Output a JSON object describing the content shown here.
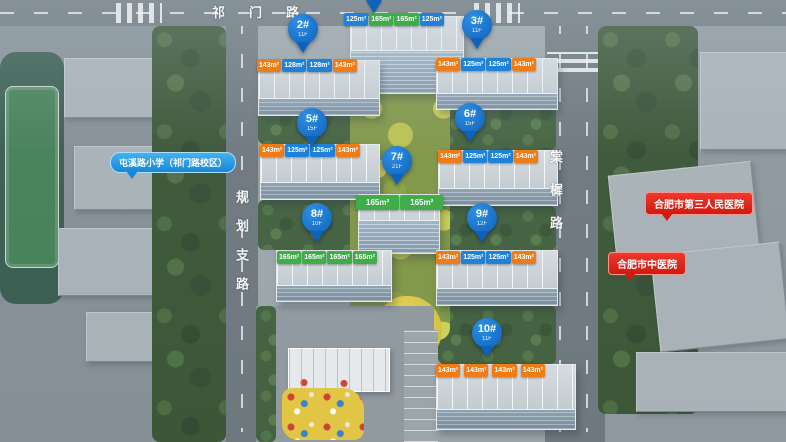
{
  "roads": {
    "top": "祁门路",
    "left": "规划支路",
    "right": "棠樨路"
  },
  "pois": {
    "school": "屯溪路小学（祁门路校区）",
    "hospital_1": "合肥市第三人民医院",
    "hospital_2": "合肥市中医院"
  },
  "colors": {
    "tag_blue": "#1e82da",
    "tag_green": "#3fae49",
    "tag_orange": "#ef7c16",
    "pin_blue": "#0d63bb",
    "bubble_blue": "#1887d6",
    "bubble_red": "#e1251b"
  },
  "buildings": [
    {
      "id": "",
      "sub": "",
      "tags": [
        "125m²",
        "165m²",
        "165m²",
        "125m²"
      ],
      "tag_colors": [
        "blue",
        "green",
        "green",
        "blue"
      ]
    },
    {
      "id": "2#",
      "sub": "11F",
      "tags": [
        "143m²",
        "128m²",
        "128m²",
        "143m²"
      ],
      "tag_colors": [
        "orange",
        "blue",
        "blue",
        "orange"
      ]
    },
    {
      "id": "3#",
      "sub": "11F",
      "tags": [
        "143m²",
        "125m²",
        "125m²",
        "143m²"
      ],
      "tag_colors": [
        "orange",
        "blue",
        "blue",
        "orange"
      ]
    },
    {
      "id": "5#",
      "sub": "15F",
      "tags": [
        "143m²",
        "125m²",
        "125m²",
        "143m²"
      ],
      "tag_colors": [
        "orange",
        "blue",
        "blue",
        "orange"
      ]
    },
    {
      "id": "6#",
      "sub": "15F",
      "tags": [
        "143m²",
        "125m²",
        "125m²",
        "143m²"
      ],
      "tag_colors": [
        "orange",
        "blue",
        "blue",
        "orange"
      ]
    },
    {
      "id": "7#",
      "sub": "21F",
      "tags": [
        "165m²",
        "165m²"
      ],
      "tag_colors": [
        "green",
        "green"
      ]
    },
    {
      "id": "8#",
      "sub": "10F",
      "tags": [
        "165m²",
        "165m²",
        "165m²",
        "165m²"
      ],
      "tag_colors": [
        "green",
        "green",
        "green",
        "green"
      ]
    },
    {
      "id": "9#",
      "sub": "12F",
      "tags": [
        "143m²",
        "125m²",
        "125m²",
        "143m²"
      ],
      "tag_colors": [
        "orange",
        "blue",
        "blue",
        "orange"
      ]
    },
    {
      "id": "10#",
      "sub": "11F",
      "tags": [
        "143m²",
        "143m²",
        "143m²",
        "143m²"
      ],
      "tag_colors": [
        "orange",
        "orange",
        "orange",
        "orange"
      ]
    }
  ]
}
